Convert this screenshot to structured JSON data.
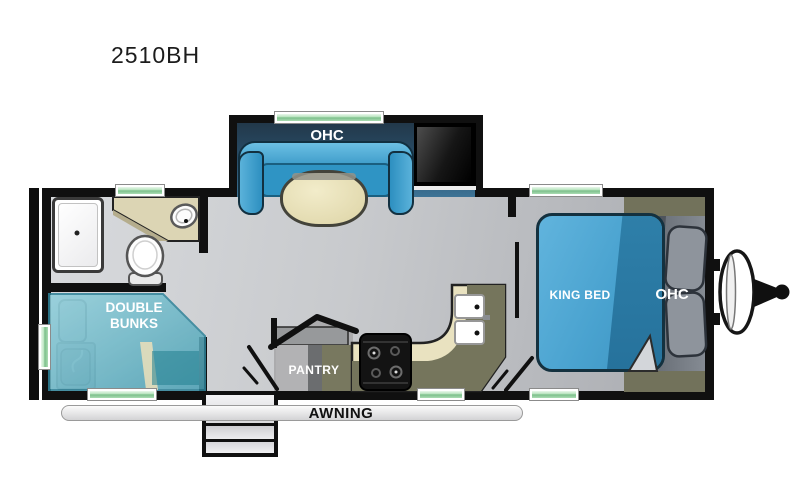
{
  "title": "2510BH",
  "labels": {
    "slide_ohc": "OHC",
    "bed_ohc": "OHC",
    "king_bed": "KING BED",
    "double_bunks_line1": "DOUBLE",
    "double_bunks_line2": "BUNKS",
    "pantry": "PANTRY",
    "awning": "AWNING"
  },
  "fixtures": [
    "shower",
    "toilet",
    "vanity-sink",
    "double-bunks",
    "dinette-sofa",
    "dinette-table",
    "tv",
    "kitchen-counter",
    "double-kitchen-sink",
    "stove",
    "pantry-cabinet",
    "king-bed",
    "pillows",
    "entry-steps",
    "awning-rail",
    "spare-tire",
    "hitch",
    "rear-bumper"
  ],
  "colors": {
    "wall": "#101010",
    "floor": "#c8cacd",
    "slide_interior": "#2a516d",
    "sofa_blue": "#2d8fc0",
    "table_cream": "#e6dfb8",
    "bed_blue": "#49a2cf",
    "bed_blue_dark": "#2e7fa9",
    "bunks_teal": "#62b3c3",
    "counter_olive": "#75755c",
    "counter_cream": "#e9e2c0",
    "window_green": "#9fd4aa",
    "awning_gray": "#e9e9eb",
    "label_white": "#ffffff"
  }
}
